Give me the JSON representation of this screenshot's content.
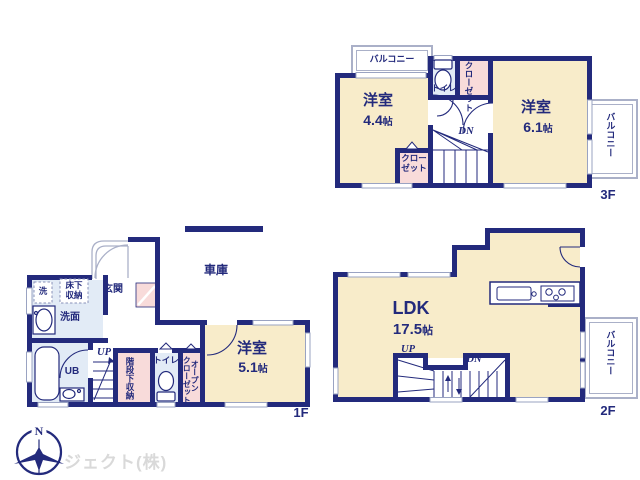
{
  "size_unit": "帖",
  "colors": {
    "wall_navy": "#232a7c",
    "room_cream": "#f8ecca",
    "closet_pink": "#f8dbda",
    "wet_area_blue": "#e2ebf6",
    "balcony_gray": "#aab0c8",
    "watermark_gray": "#d9d9d9"
  },
  "floor3": {
    "label": "3F",
    "balcony_top": "バルコニー",
    "balcony_right": "バルコニー",
    "room1_name": "洋室",
    "room1_size": "4.4",
    "room2_name": "洋室",
    "room2_size": "6.1",
    "toilet": "トイレ",
    "closet_top": "クローゼット",
    "closet_bottom": [
      "クロー",
      "ゼット"
    ],
    "stairs_dn": "DN"
  },
  "floor2": {
    "label": "2F",
    "ldk_name": "LDK",
    "ldk_size": "17.5",
    "stairs_up": "UP",
    "stairs_dn": "DN",
    "balcony_right": "バルコニー"
  },
  "floor1": {
    "label": "1F",
    "garage": "車庫",
    "entrance": "玄関",
    "laundry": "洗",
    "underfloor_storage": [
      "床下",
      "収納"
    ],
    "washroom": "洗面",
    "unit_bath": "UB",
    "stairs_up": "UP",
    "under_stair_storage": "階段下収納",
    "toilet": "トイレ",
    "open_closet": [
      "オープン",
      "クローゼット"
    ],
    "room_name": "洋室",
    "room_size": "5.1"
  },
  "footer": {
    "company": "ジェクト(株)",
    "compass_north": "N"
  }
}
